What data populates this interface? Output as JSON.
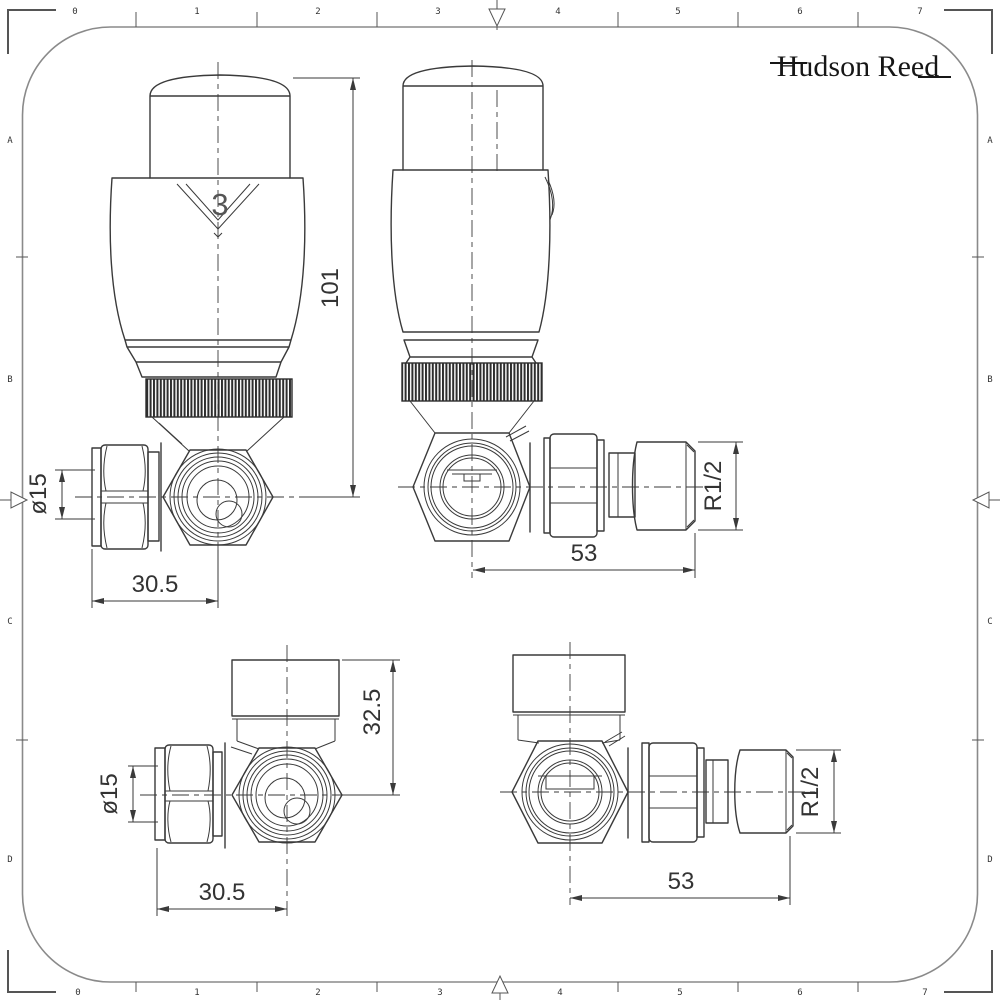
{
  "sheet": {
    "logo_text": "Hudson Reed",
    "line_color": "#3a3a3a",
    "border_color": "#8a8a8a"
  },
  "rulers": {
    "top": [
      "0",
      "1",
      "2",
      "3",
      "4",
      "5",
      "6",
      "7"
    ],
    "bottom": [
      "0",
      "1",
      "2",
      "3",
      "4",
      "5",
      "6",
      "7"
    ],
    "left": [
      "A",
      "B",
      "C",
      "D"
    ],
    "right": [
      "A",
      "B",
      "C",
      "D"
    ]
  },
  "drawings": {
    "trv_front": {
      "label": "thermostatic-radiator-valve-front-view",
      "head_setting": "3",
      "dim_height": "101",
      "dim_pipe": "ø15",
      "dim_center": "30.5"
    },
    "trv_side": {
      "label": "thermostatic-radiator-valve-side-view",
      "dim_length": "53",
      "dim_thread": "R1/2"
    },
    "corner_front": {
      "label": "corner-valve-front-view",
      "dim_height": "32.5",
      "dim_pipe": "ø15",
      "dim_center": "30.5"
    },
    "corner_side": {
      "label": "corner-valve-side-view",
      "dim_length": "53",
      "dim_thread": "R1/2"
    }
  }
}
